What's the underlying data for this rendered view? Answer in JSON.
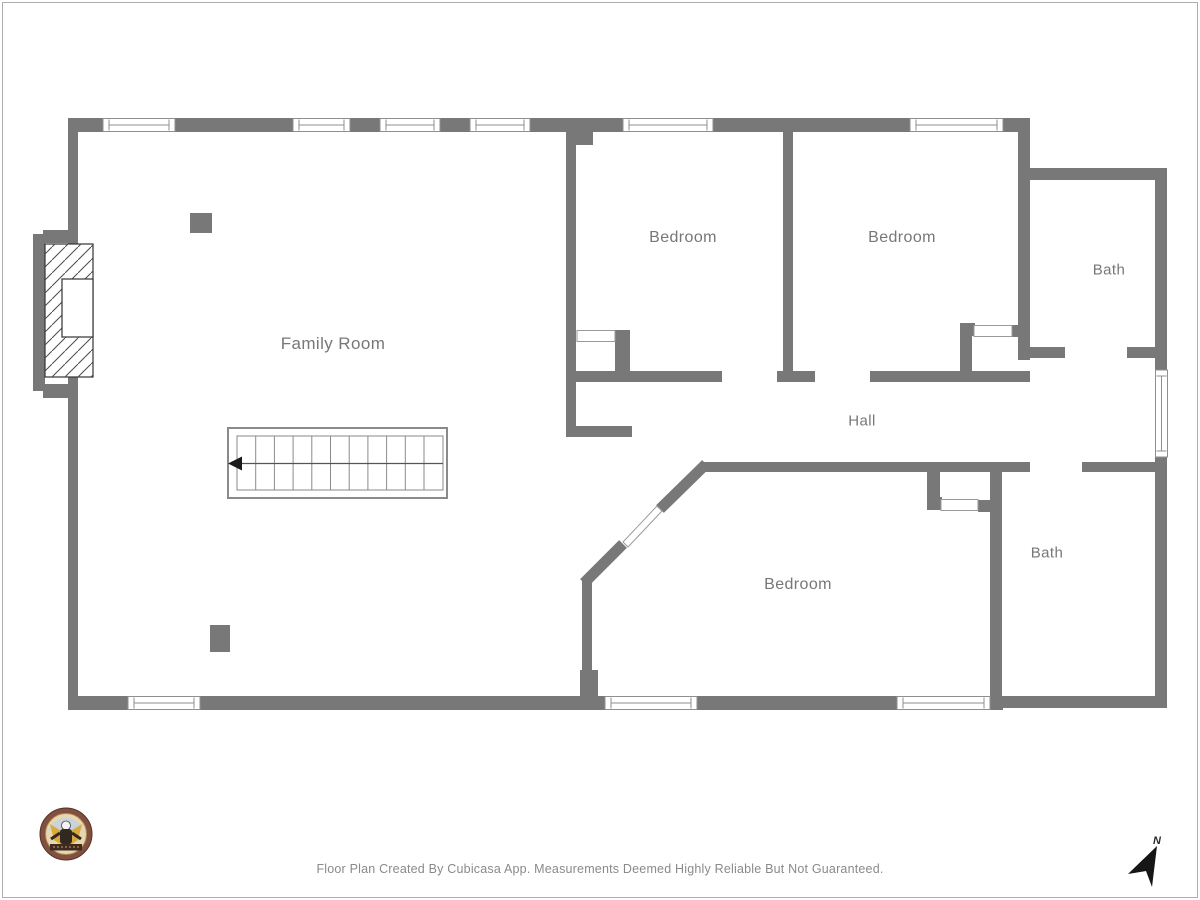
{
  "title": "Floor Plan",
  "colors": {
    "wall": "#787878",
    "label": "#777777",
    "window_frame": "#8f8f8f",
    "stair_outline": "#8a8a8a",
    "footer_text": "#8a8a8a",
    "north_arrow": "#161616"
  },
  "rooms": [
    {
      "id": "family-room",
      "label": "Family Room"
    },
    {
      "id": "bedroom-1",
      "label": "Bedroom"
    },
    {
      "id": "bedroom-2",
      "label": "Bedroom"
    },
    {
      "id": "bath-1",
      "label": "Bath"
    },
    {
      "id": "hall",
      "label": "Hall"
    },
    {
      "id": "bedroom-3",
      "label": "Bedroom"
    },
    {
      "id": "bath-2",
      "label": "Bath"
    }
  ],
  "compass": {
    "label": "N"
  },
  "footer": {
    "text": "Floor Plan Created By Cubicasa App. Measurements Deemed Highly Reliable But Not Guaranteed."
  },
  "logo": {
    "name": "builder-logo-badge"
  }
}
